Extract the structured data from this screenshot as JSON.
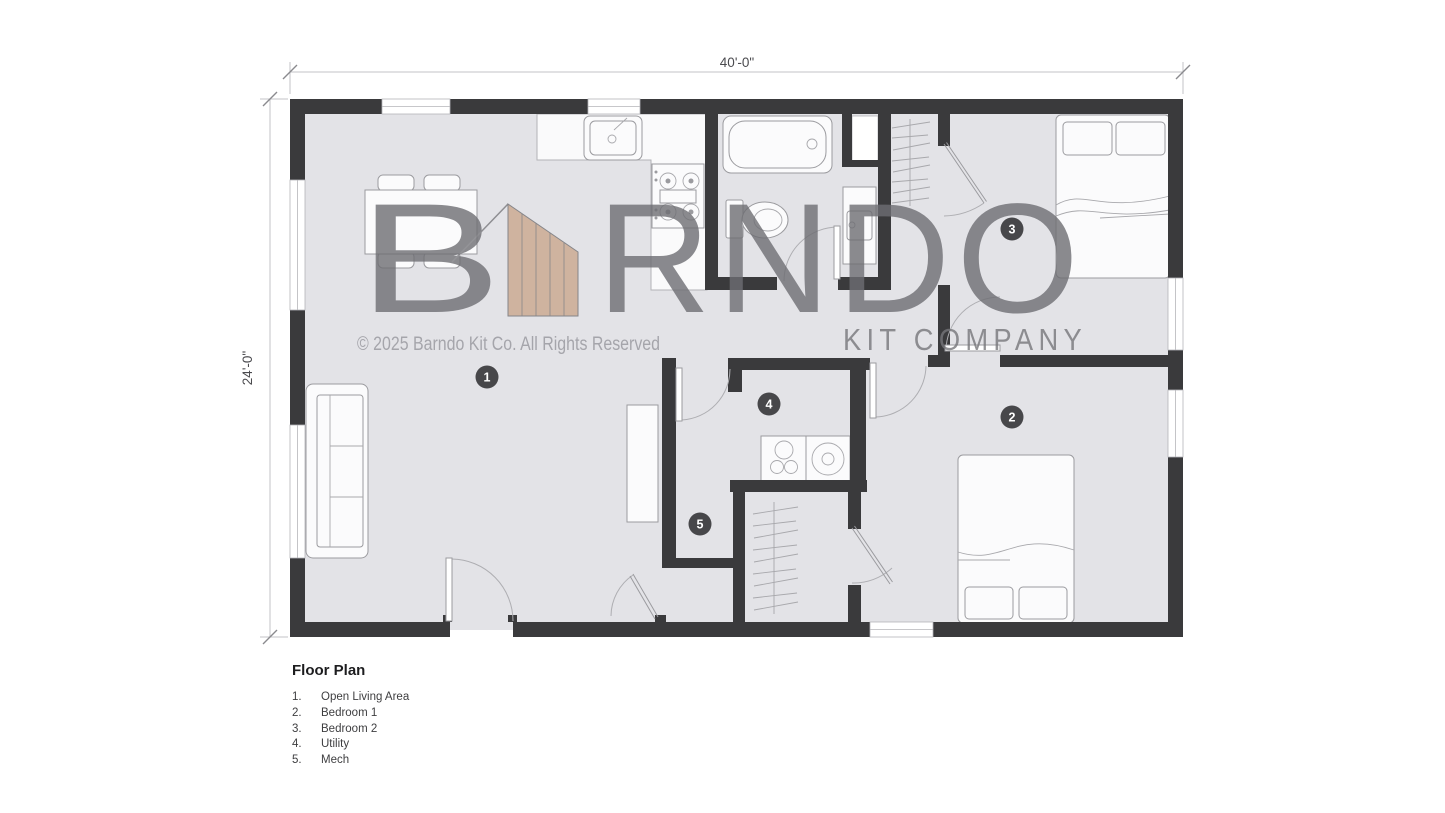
{
  "dimensions": {
    "width_label": "40'-0\"",
    "height_label": "24'-0\""
  },
  "watermark": {
    "brand_prefix": "B",
    "brand_suffix": "RNDO",
    "tagline": "KIT COMPANY",
    "copyright": "© 2025 Barndo Kit Co. All Rights Reserved"
  },
  "room_markers": [
    {
      "number": "1",
      "name": "Open Living Area"
    },
    {
      "number": "2",
      "name": "Bedroom 1"
    },
    {
      "number": "3",
      "name": "Bedroom 2"
    },
    {
      "number": "4",
      "name": "Utility"
    },
    {
      "number": "5",
      "name": "Mech"
    }
  ],
  "legend": {
    "title": "Floor Plan",
    "items": [
      {
        "num": "1.",
        "label": "Open Living Area"
      },
      {
        "num": "2.",
        "label": "Bedroom 1"
      },
      {
        "num": "3.",
        "label": "Bedroom 2"
      },
      {
        "num": "4.",
        "label": "Utility"
      },
      {
        "num": "5.",
        "label": "Mech"
      }
    ]
  },
  "colors": {
    "wall": "#3a3a3c",
    "floor": "#e3e3e7",
    "accent_wood": "#c8a284",
    "watermark_gray": "#77777b"
  }
}
